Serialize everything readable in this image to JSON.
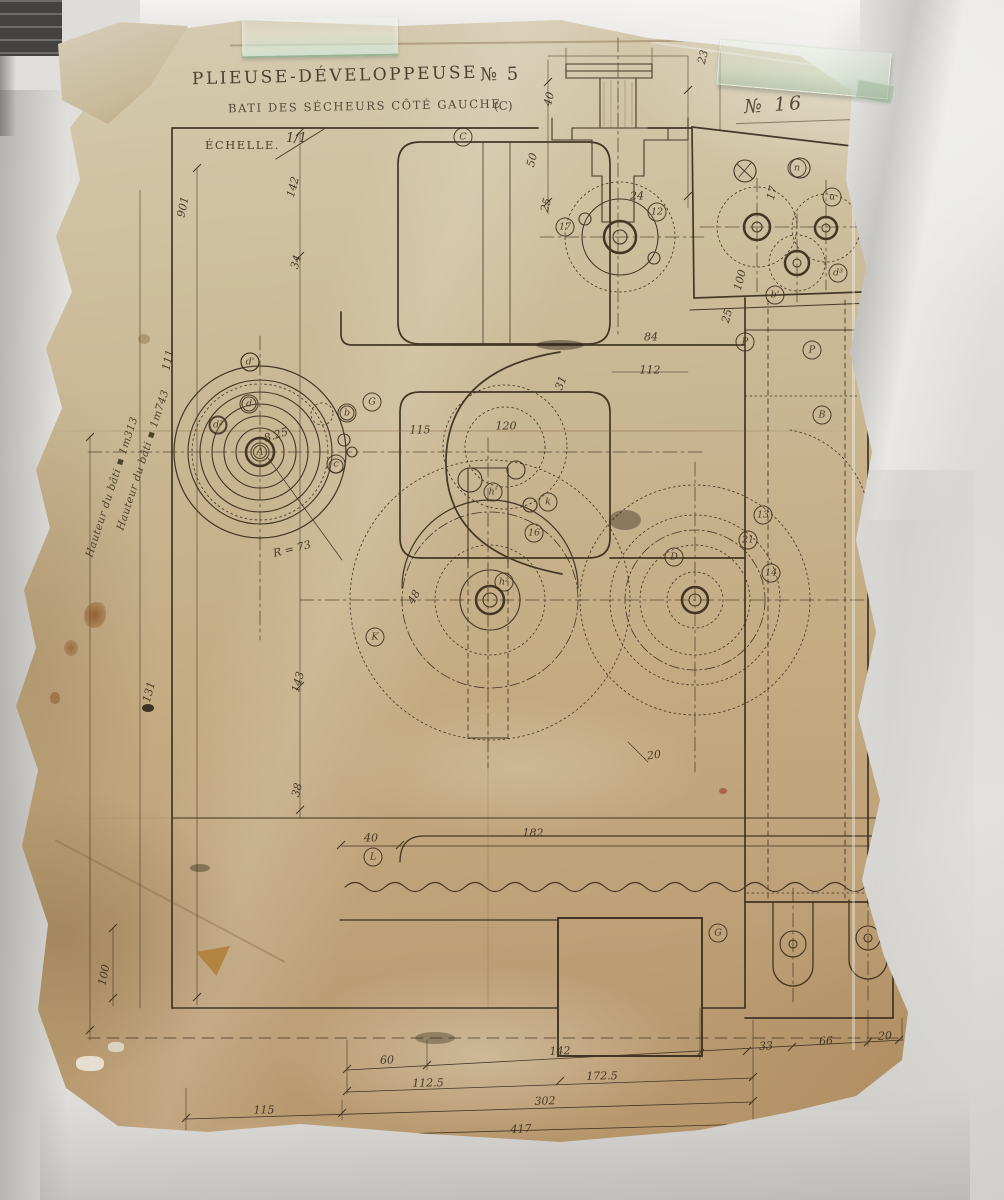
{
  "title_block": {
    "title": "PLIEUSE-DÉVELOPPEUSE",
    "machine_number": "№ 5",
    "subtitle": "BATI DES SÉCHEURS CÔTÉ GAUCHE",
    "subtitle_ref": "(C)",
    "scale_label": "ÉCHELLE.",
    "scale_value": "1/1",
    "sheet_number": "№ 16"
  },
  "annotations": {
    "notes": [
      {
        "text": "Hauteur du bâti ▪ 1m313",
        "x": 112,
        "y": 487,
        "rot": -72
      },
      {
        "text": "Hauteur du bâti ▪ 1m743",
        "x": 143,
        "y": 460,
        "rot": -72
      }
    ]
  },
  "drawing": {
    "ink_color": "#36291a",
    "paper_color": "#c8b590",
    "dimensions": [
      {
        "text": "901",
        "x": 183,
        "y": 207,
        "rot": -78
      },
      {
        "text": "142",
        "x": 293,
        "y": 187,
        "rot": -75
      },
      {
        "text": "34",
        "x": 296,
        "y": 262,
        "rot": -75
      },
      {
        "text": "111",
        "x": 168,
        "y": 360,
        "rot": -78
      },
      {
        "text": "8.25",
        "x": 276,
        "y": 435,
        "rot": -18
      },
      {
        "text": "R = 73",
        "x": 292,
        "y": 549,
        "rot": -14
      },
      {
        "text": "115",
        "x": 420,
        "y": 430,
        "rot": 0
      },
      {
        "text": "120",
        "x": 506,
        "y": 426,
        "rot": 0
      },
      {
        "text": "112",
        "x": 650,
        "y": 370,
        "rot": 0
      },
      {
        "text": "48",
        "x": 414,
        "y": 597,
        "rot": -60
      },
      {
        "text": "143",
        "x": 298,
        "y": 682,
        "rot": -75
      },
      {
        "text": "131",
        "x": 149,
        "y": 692,
        "rot": -75
      },
      {
        "text": "38",
        "x": 297,
        "y": 790,
        "rot": -75
      },
      {
        "text": "100",
        "x": 104,
        "y": 975,
        "rot": -78
      },
      {
        "text": "40",
        "x": 371,
        "y": 838,
        "rot": 0
      },
      {
        "text": "182",
        "x": 533,
        "y": 833,
        "rot": 0
      },
      {
        "text": "20",
        "x": 654,
        "y": 755,
        "rot": -8
      },
      {
        "text": "40",
        "x": 549,
        "y": 99,
        "rot": -75
      },
      {
        "text": "50",
        "x": 532,
        "y": 160,
        "rot": -75
      },
      {
        "text": "25",
        "x": 546,
        "y": 205,
        "rot": -75
      },
      {
        "text": "23",
        "x": 703,
        "y": 57,
        "rot": -75
      },
      {
        "text": "24",
        "x": 637,
        "y": 196,
        "rot": 0
      },
      {
        "text": "84",
        "x": 651,
        "y": 337,
        "rot": 0
      },
      {
        "text": "100",
        "x": 740,
        "y": 280,
        "rot": -75
      },
      {
        "text": "25",
        "x": 727,
        "y": 316,
        "rot": -75
      },
      {
        "text": "31",
        "x": 561,
        "y": 383,
        "rot": -70
      },
      {
        "text": "17",
        "x": 772,
        "y": 193,
        "rot": -75
      },
      {
        "text": "60",
        "x": 387,
        "y": 1060,
        "rot": -2
      },
      {
        "text": "142",
        "x": 560,
        "y": 1051,
        "rot": -2
      },
      {
        "text": "33",
        "x": 766,
        "y": 1046,
        "rot": -3
      },
      {
        "text": "66",
        "x": 826,
        "y": 1041,
        "rot": -3
      },
      {
        "text": "20",
        "x": 885,
        "y": 1036,
        "rot": -3
      },
      {
        "text": "112.5",
        "x": 428,
        "y": 1083,
        "rot": -1
      },
      {
        "text": "172.5",
        "x": 602,
        "y": 1076,
        "rot": -1
      },
      {
        "text": "115",
        "x": 264,
        "y": 1110,
        "rot": -1
      },
      {
        "text": "302",
        "x": 545,
        "y": 1101,
        "rot": -2
      },
      {
        "text": "417",
        "x": 521,
        "y": 1129,
        "rot": -2
      }
    ],
    "parts": [
      {
        "text": "A",
        "x": 260,
        "y": 452
      },
      {
        "text": "C",
        "x": 463,
        "y": 137
      },
      {
        "text": "G",
        "x": 372,
        "y": 402
      },
      {
        "text": "d'",
        "x": 250,
        "y": 362
      },
      {
        "text": "d²",
        "x": 218,
        "y": 425
      },
      {
        "text": "d",
        "x": 249,
        "y": 404
      },
      {
        "text": "b",
        "x": 347,
        "y": 413
      },
      {
        "text": "c",
        "x": 336,
        "y": 464
      },
      {
        "text": "K",
        "x": 375,
        "y": 637
      },
      {
        "text": "L",
        "x": 373,
        "y": 857
      },
      {
        "text": "h'",
        "x": 493,
        "y": 492
      },
      {
        "text": "k",
        "x": 548,
        "y": 502
      },
      {
        "text": "16",
        "x": 534,
        "y": 533
      },
      {
        "text": "h²",
        "x": 504,
        "y": 582
      },
      {
        "text": "12",
        "x": 657,
        "y": 212
      },
      {
        "text": "17",
        "x": 565,
        "y": 227
      },
      {
        "text": "13",
        "x": 763,
        "y": 515
      },
      {
        "text": "21",
        "x": 748,
        "y": 540
      },
      {
        "text": "14",
        "x": 771,
        "y": 573
      },
      {
        "text": "D",
        "x": 674,
        "y": 557
      },
      {
        "text": "P",
        "x": 745,
        "y": 342
      },
      {
        "text": "P",
        "x": 812,
        "y": 350
      },
      {
        "text": "B",
        "x": 822,
        "y": 415
      },
      {
        "text": "n",
        "x": 797,
        "y": 168
      },
      {
        "text": "u",
        "x": 832,
        "y": 197
      },
      {
        "text": "d³",
        "x": 838,
        "y": 273
      },
      {
        "text": "b'",
        "x": 775,
        "y": 295
      },
      {
        "text": "G",
        "x": 718,
        "y": 933
      }
    ]
  }
}
